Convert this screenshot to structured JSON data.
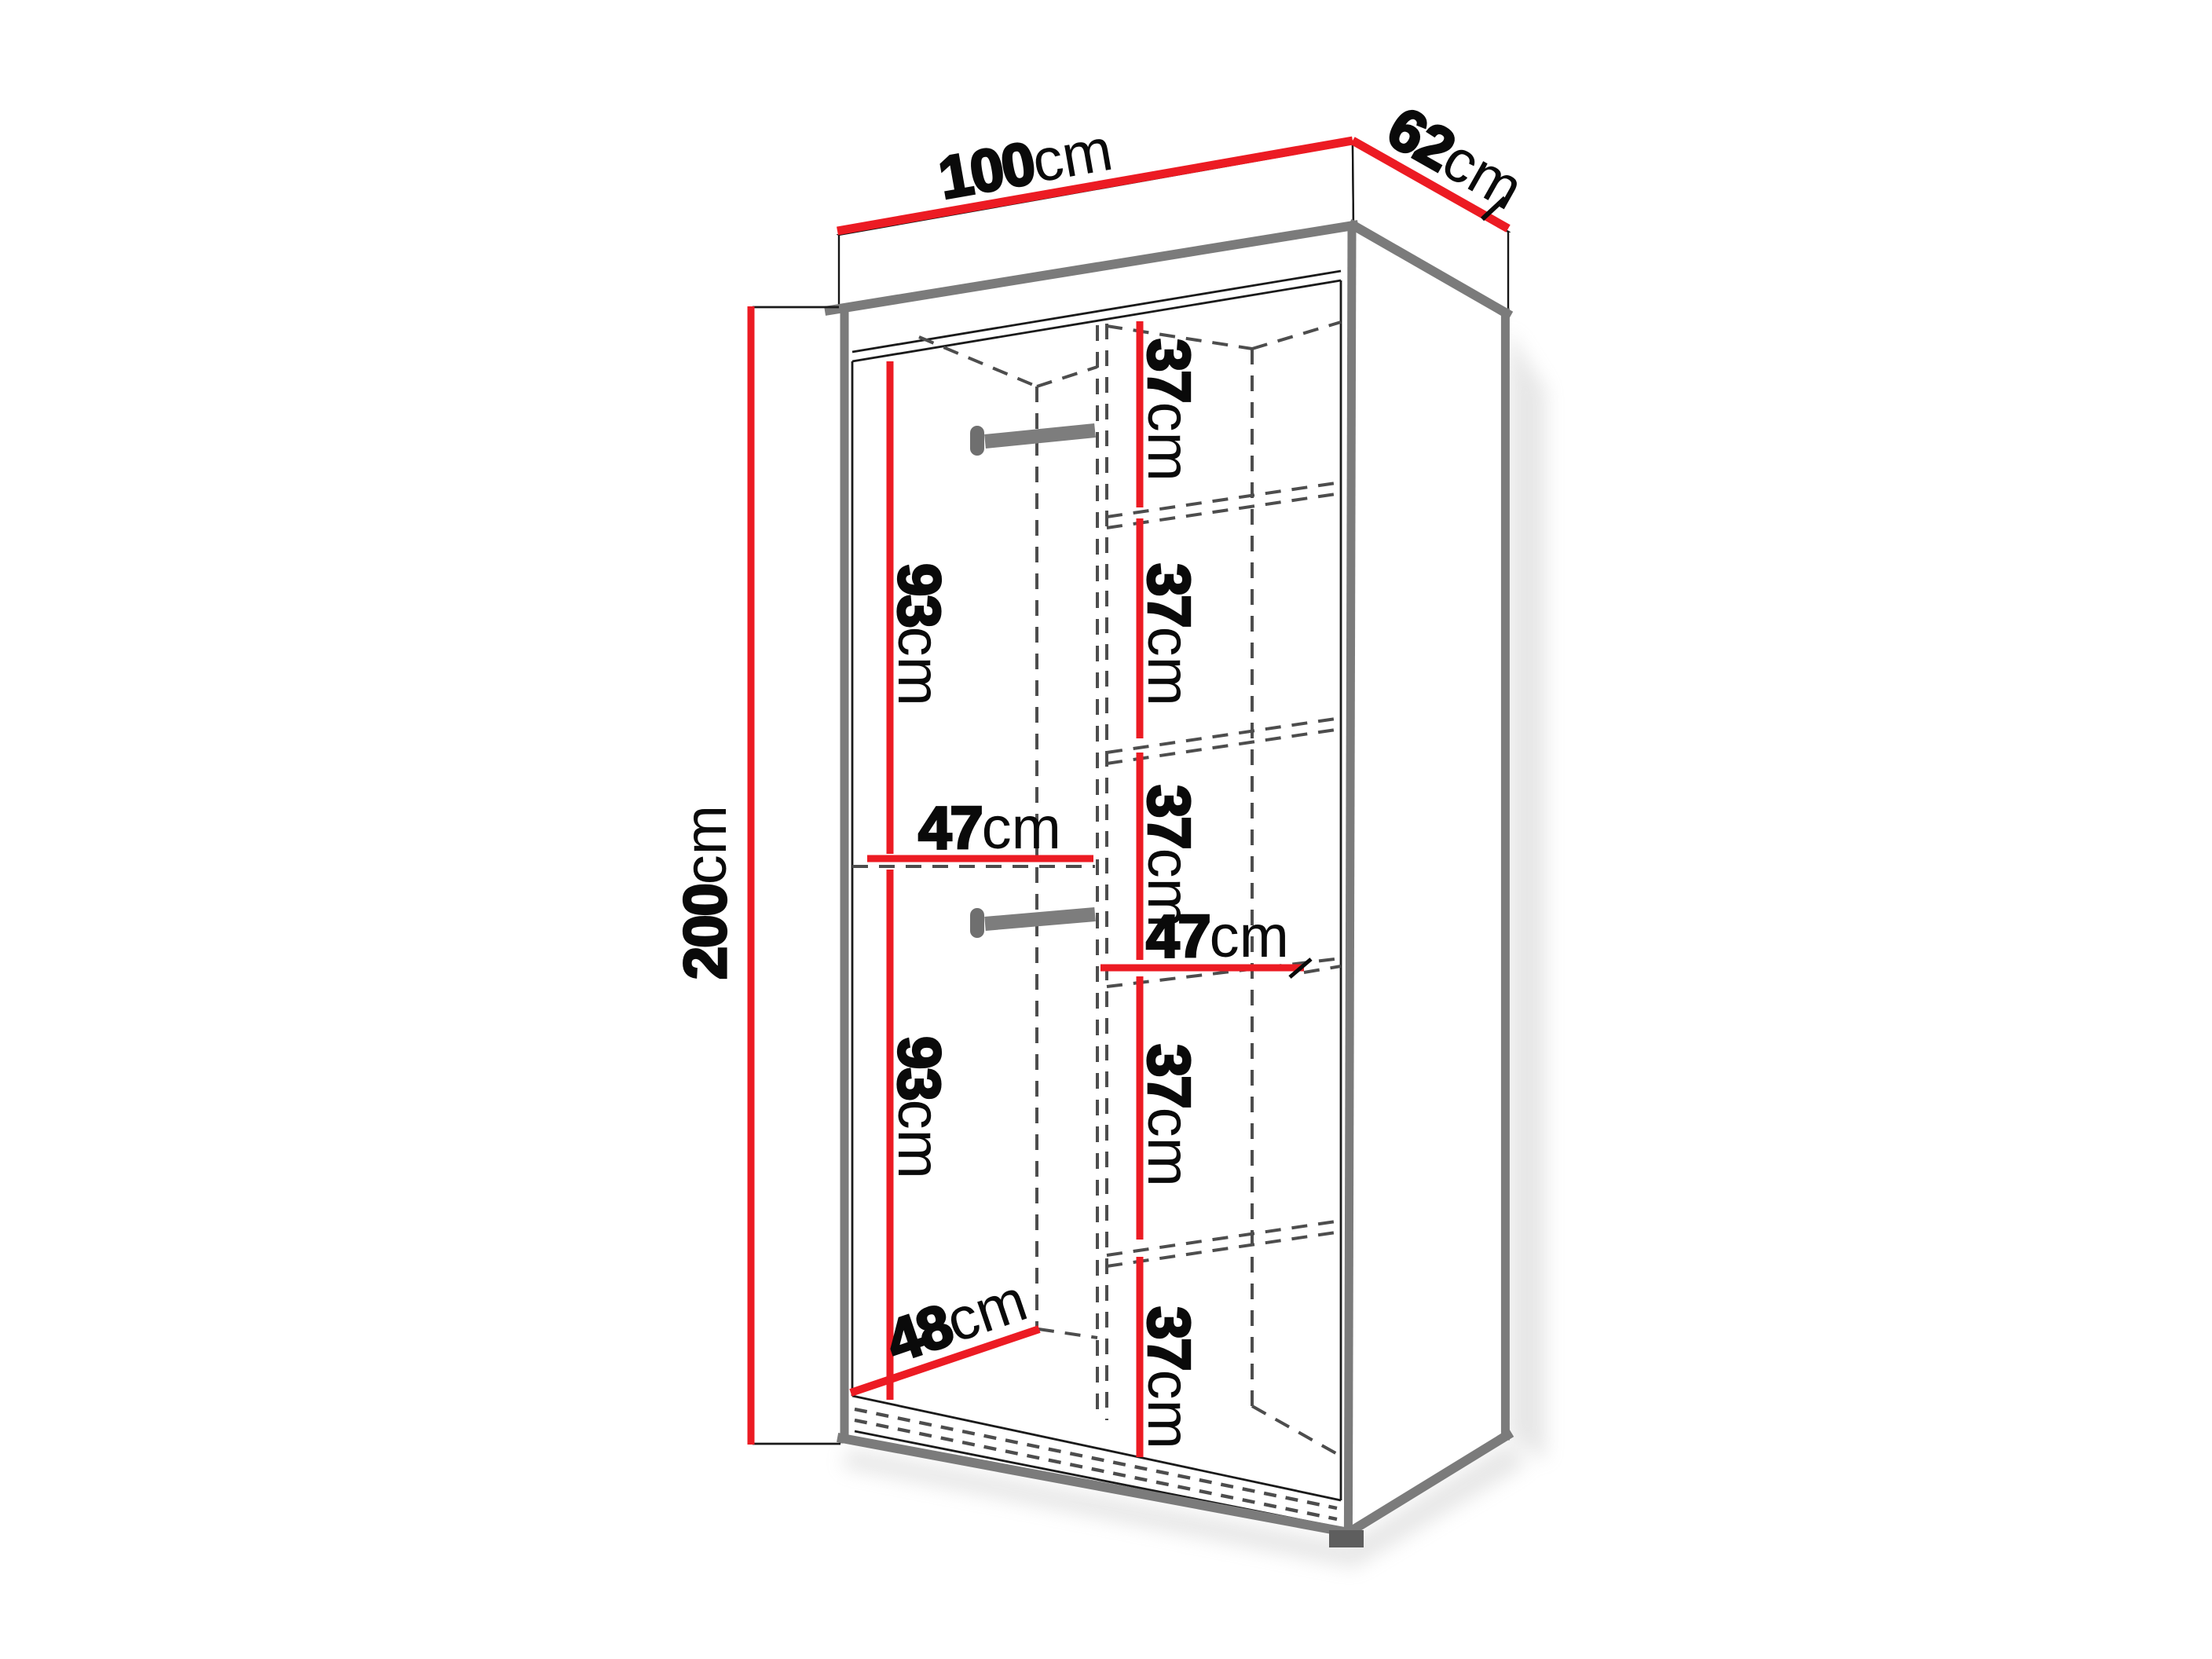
{
  "diagram": {
    "name": "wardrobe-dimension-diagram",
    "colors": {
      "dimension_line": "#ec1b23",
      "cabinet_edge": "#7b7b7b",
      "hidden_line": "#4d4d4d",
      "label_text": "#0a0a0a",
      "background": "#ffffff"
    },
    "dimensions": {
      "width": {
        "value": "100",
        "unit": "cm"
      },
      "depth": {
        "value": "62",
        "unit": "cm"
      },
      "height": {
        "value": "200",
        "unit": "cm"
      },
      "left_upper_section_height": {
        "value": "93",
        "unit": "cm"
      },
      "left_middle_shelf_width": {
        "value": "47",
        "unit": "cm"
      },
      "left_lower_section_height": {
        "value": "93",
        "unit": "cm"
      },
      "left_section_depth": {
        "value": "48",
        "unit": "cm"
      },
      "right_middle_shelf_width": {
        "value": "47",
        "unit": "cm"
      },
      "right_shelf_gaps": [
        {
          "value": "37",
          "unit": "cm"
        },
        {
          "value": "37",
          "unit": "cm"
        },
        {
          "value": "37",
          "unit": "cm"
        },
        {
          "value": "37",
          "unit": "cm"
        },
        {
          "value": "37",
          "unit": "cm"
        }
      ]
    }
  }
}
